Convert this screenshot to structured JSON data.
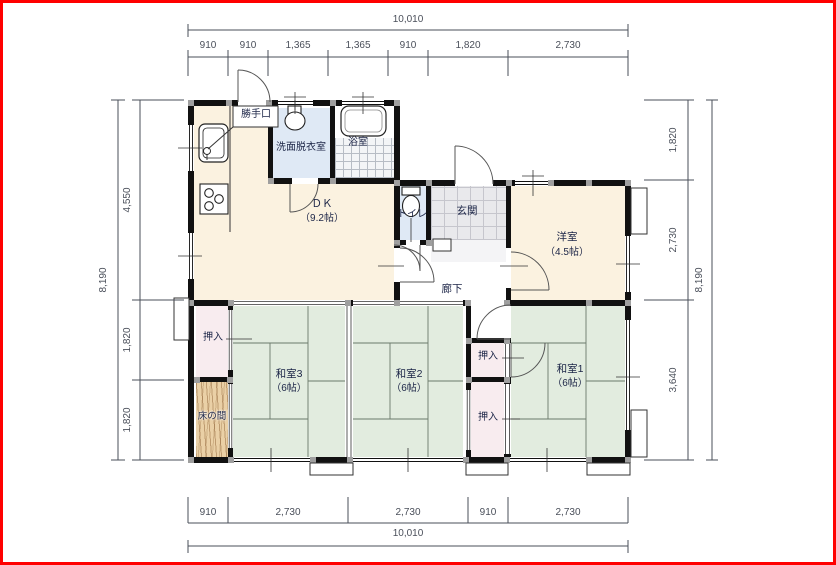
{
  "plan": {
    "rooms": {
      "dk": {
        "name": "ＤＫ",
        "size": "（9.2帖）"
      },
      "washroom": {
        "name": "洗面脱衣室"
      },
      "bathroom": {
        "name": "浴室"
      },
      "kitchen_door": {
        "name": "勝手口"
      },
      "toilet": {
        "name": "トイレ"
      },
      "entrance": {
        "name": "玄関"
      },
      "corridor": {
        "name": "廊下"
      },
      "western_room": {
        "name": "洋室",
        "size": "（4.5帖）"
      },
      "washitsu1": {
        "name": "和室1",
        "size": "（6帖）"
      },
      "washitsu2": {
        "name": "和室2",
        "size": "（6帖）"
      },
      "washitsu3": {
        "name": "和室3",
        "size": "（6帖）"
      },
      "closet_left": {
        "name": "押入"
      },
      "closet_right_upper": {
        "name": "押入"
      },
      "closet_right_lower": {
        "name": "押入"
      },
      "tokonoma": {
        "name": "床の間"
      }
    },
    "dimensions": {
      "top": {
        "total": "10,010",
        "segments": [
          "910",
          "910",
          "1,365",
          "1,365",
          "910",
          "1,820",
          "2,730"
        ]
      },
      "bottom": {
        "total": "10,010",
        "segments": [
          "910",
          "2,730",
          "2,730",
          "910",
          "2,730"
        ]
      },
      "left": {
        "total": "8,190",
        "segments": [
          "4,550",
          "1,820",
          "1,820"
        ]
      },
      "right": {
        "total": "8,190",
        "segments": [
          "1,820",
          "2,730",
          "3,640"
        ]
      }
    },
    "colors": {
      "frame_border": "#ff0000",
      "wall": "#111111",
      "pillar": "#9f9f9f",
      "flooring_cream": "#fbf2e0",
      "tatami_green": "#e2ecdf",
      "closet_pink": "#f8ecef",
      "wet_area_blue": "#dfe9f5",
      "tokonoma_wood": "#ead0a6",
      "entrance_gray": "#e9e9ec",
      "dimension_text": "#4a4f5a",
      "label_text": "#1c2547"
    }
  }
}
